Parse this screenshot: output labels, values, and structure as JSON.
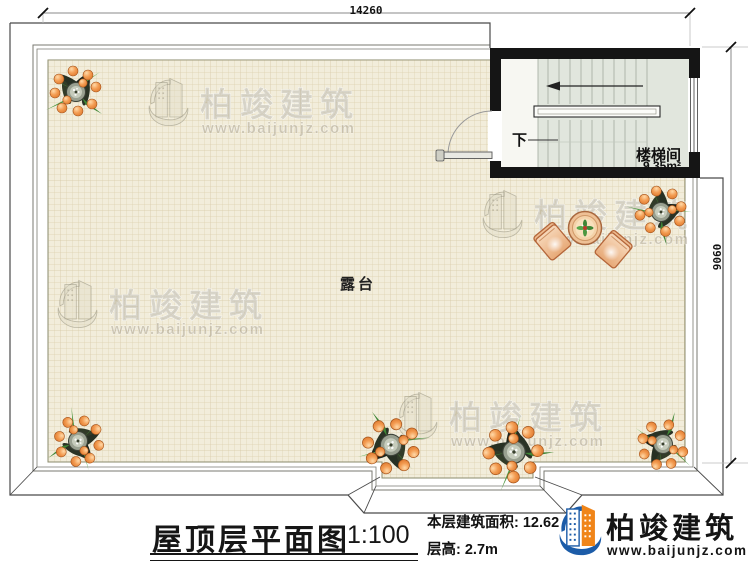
{
  "drawing": {
    "plan_title": "屋顶层平面图",
    "scale": "1:100",
    "area_note": "本层建筑面积: 12.62",
    "floor_height_note": "层高: 2.7m"
  },
  "dimensions": {
    "top_width": "14260",
    "right_height": "9060"
  },
  "rooms": {
    "terrace": "露台",
    "stairwell": "楼梯间",
    "stairwell_area": "9.35m²",
    "stair_direction": "下"
  },
  "branding": {
    "company": "柏竣建筑",
    "website": "www.baijunjz.com"
  },
  "watermark": {
    "company": "柏竣建筑",
    "website": "www.baijunjz.com"
  },
  "colors": {
    "tile": "#f2eddb",
    "wall_black": "#151515",
    "stair_interior": "#e1e6dd",
    "logo_blue": "#1c5ca8",
    "logo_orange": "#f08519",
    "fruit_orange": "#e07b32"
  }
}
